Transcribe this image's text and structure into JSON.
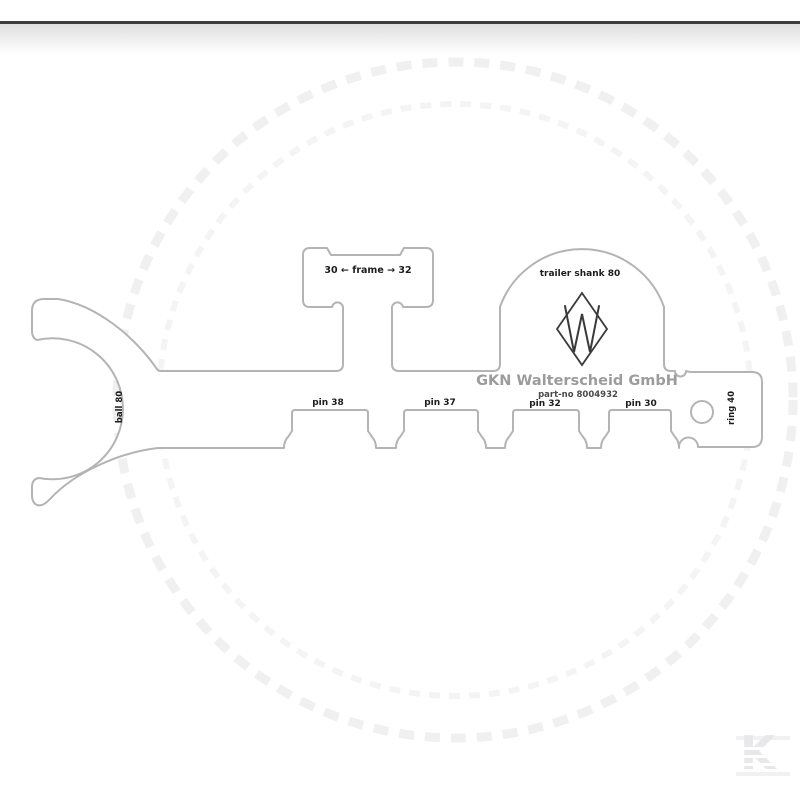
{
  "image": {
    "description": "Technical outline drawing of a GKN Walterscheid trailer-hitch measuring gauge on white product-photo background"
  },
  "colors": {
    "outline": "#b4b4b4",
    "label_text": "#1c1c1c",
    "brand_text": "#9c9c9c",
    "part_no_text": "#4a4a4a",
    "logo_stroke": "#3a3a3a",
    "top_bar": "#3c3c3c",
    "watermark": "#f1f1f1",
    "kramp_logo": "#e8e8eb"
  },
  "gauge": {
    "frame_label": "30 ← frame → 32",
    "trailer_shank_label": "trailer shank 80",
    "brand_line": "GKN Walterscheid GmbH",
    "part_no_line": "part-no 8004932",
    "pin_labels": [
      "pin 38",
      "pin 37",
      "pin 32",
      "pin 30"
    ],
    "ball_label": "ball 80",
    "ring_label": "ring 40",
    "logo_letter": "W"
  },
  "watermark": {
    "brand_letter": "K"
  }
}
